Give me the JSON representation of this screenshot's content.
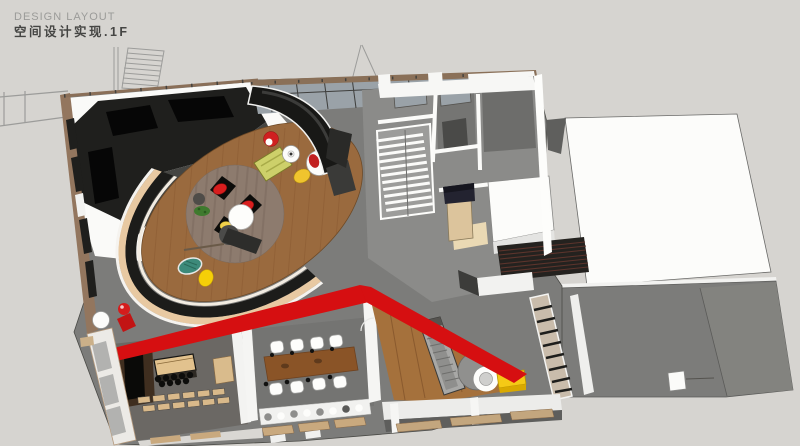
{
  "header": {
    "title": "DESIGN LAYOUT",
    "subtitle": "空间设计实现.1F"
  },
  "palette": {
    "background": "#d6d4d0",
    "floor_gray": "#7c7c7a",
    "rooms_gray": "#8b8b89",
    "roof_white": "#fcfcfa",
    "dark_furniture": "#1f1f1d",
    "wood_floor": "#9a6a3e",
    "wood_stage": "#a5713c",
    "accent_red": "#d60f11",
    "accent_yellow": "#f5c916",
    "glass": "#9aa2a8",
    "bar_wood": "#3f2e1f",
    "counter_tan": "#e2c28e",
    "table_brown": "#8a5427",
    "bench_green": "#cdd06a",
    "plate_teal": "#3d8a7a"
  },
  "scene": {
    "view": "axonometric-3d-render",
    "areas": [
      "dark-lounge-sofa",
      "oval-wood-lounge",
      "glass-curtain-wall",
      "staircase",
      "upper-rooms",
      "white-roof-terrace",
      "red-accent-stripe",
      "wood-ramp-stage",
      "meeting-room",
      "bar-counter",
      "gray-terrace"
    ]
  }
}
